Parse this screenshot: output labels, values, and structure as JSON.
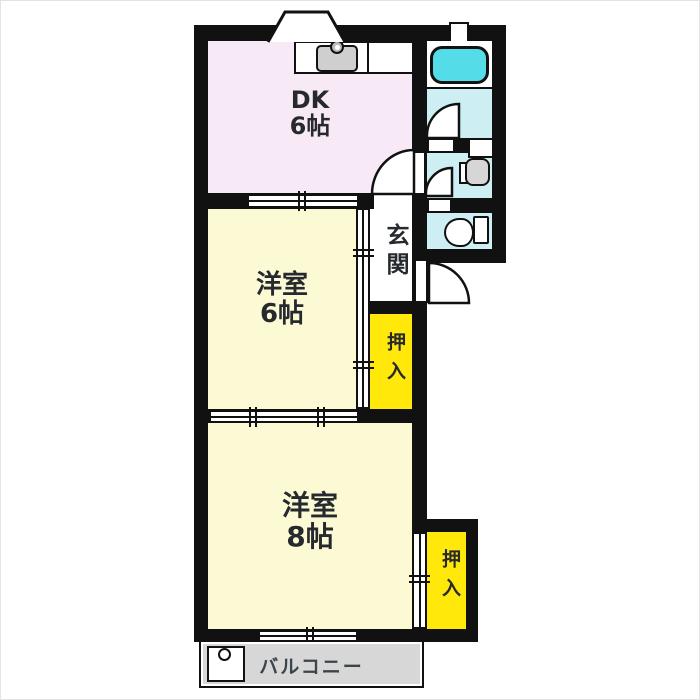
{
  "rooms": {
    "dk": {
      "label": "DK",
      "size": "6帖"
    },
    "west6": {
      "label": "洋室",
      "size": "6帖"
    },
    "west8": {
      "label": "洋室",
      "size": "8帖"
    },
    "genkan": {
      "label": "玄関"
    },
    "closet1": {
      "label": "押入"
    },
    "closet2": {
      "label": "押入"
    },
    "balcony": {
      "label": "バルコニー"
    }
  },
  "fixtures": {
    "kitchen_sink": "kitchen-sink-icon",
    "bathtub": "bathtub-icon",
    "washbasin": "washbasin-icon",
    "toilet": "toilet-icon",
    "washing_machine_pan": "washing-machine-pan-icon",
    "entrance_door": "door-arc-icon",
    "room_doors": "door-arc-icon",
    "sliding_doors": "sliding-door-icon",
    "bay_window": "bay-window-icon"
  },
  "colors": {
    "wall": "#111111",
    "dk_room": "#f8e9f6",
    "western_room": "#fcfad4",
    "closet": "#ffe80a",
    "wet_area": "#cdeff3",
    "bathtub": "#54dce8",
    "balcony": "#d7d7d7",
    "fixture_gray": "#cfcfcf",
    "label_text": "#26292e"
  }
}
